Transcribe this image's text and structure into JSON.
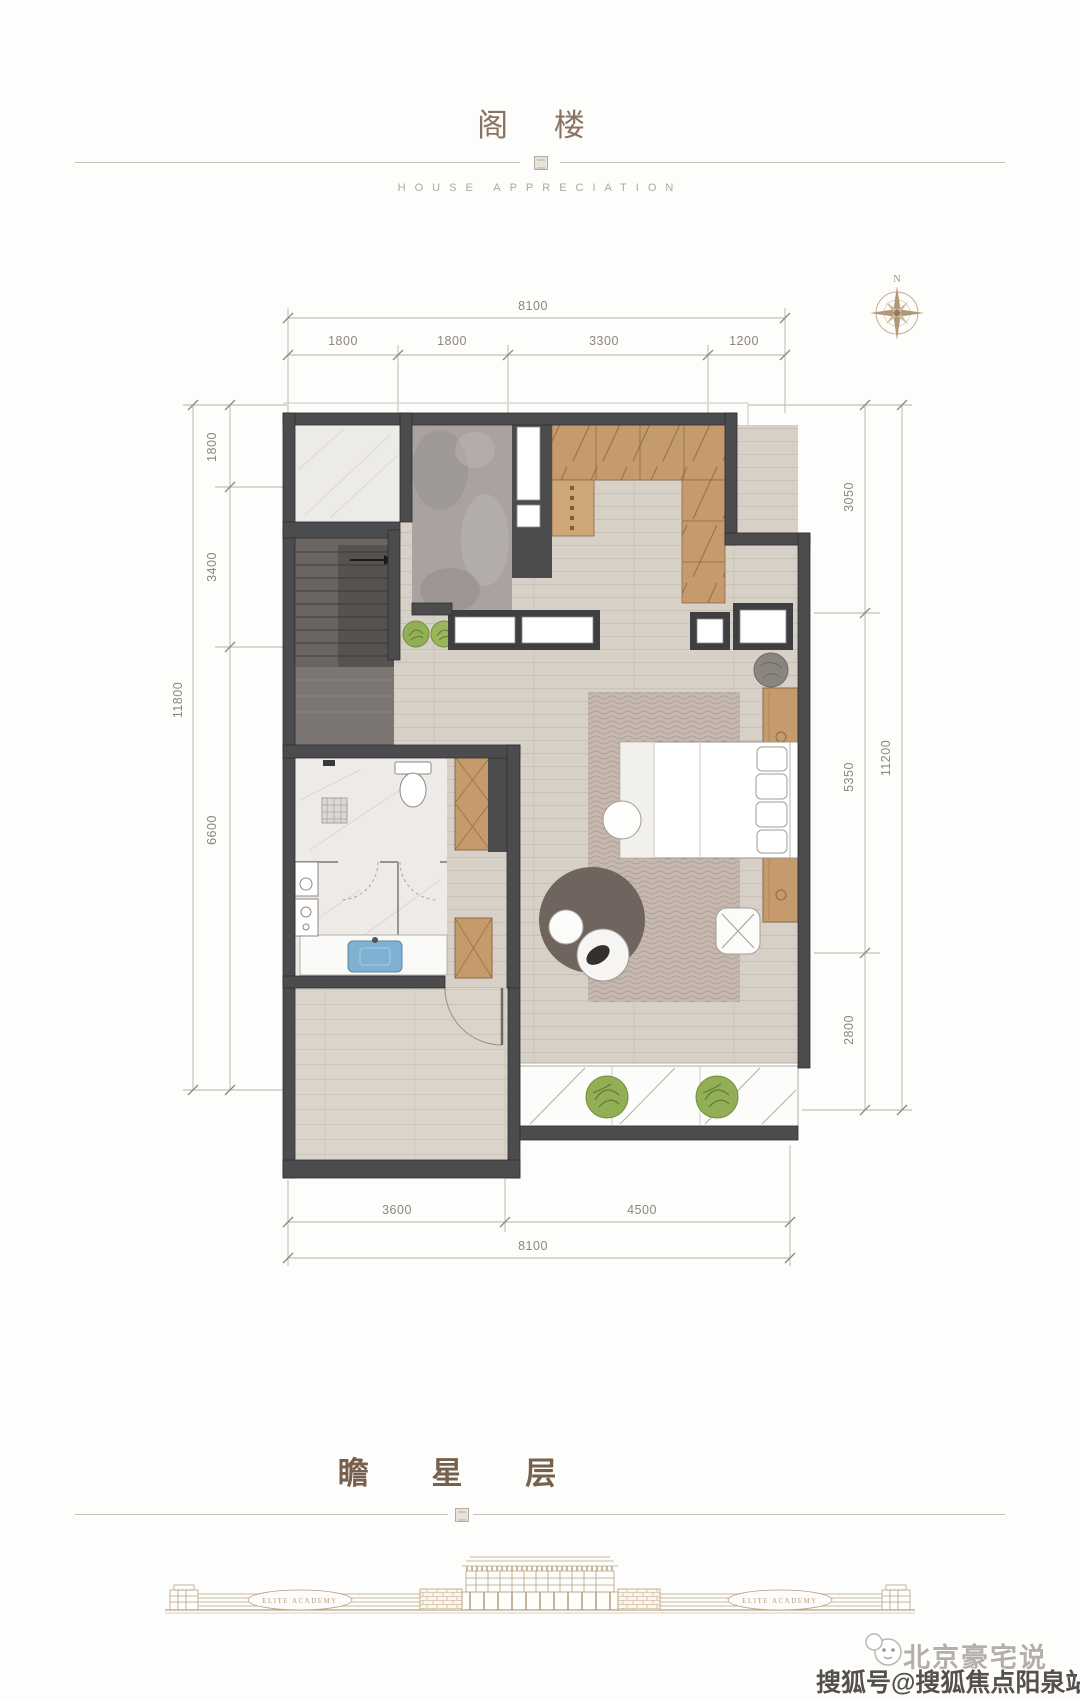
{
  "header": {
    "title": "阁 楼",
    "subtitle": "HOUSE APPRECIATION"
  },
  "footer": {
    "title": "瞻 星 层"
  },
  "compass": {
    "north": "N"
  },
  "dims": {
    "top": {
      "overall": "8100",
      "segments": [
        "1800",
        "1800",
        "3300",
        "1200"
      ]
    },
    "bottom": {
      "overall": "8100",
      "segments": [
        "3600",
        "4500"
      ]
    },
    "left": {
      "overall": "11800",
      "segments": [
        "1800",
        "3400",
        "6600"
      ]
    },
    "right": {
      "overall": "11200",
      "segments": [
        "3050",
        "5350",
        "2800"
      ]
    }
  },
  "elevation": {
    "left_label": "ELITE ACADEMY",
    "right_label": "ELITE ACADEMY"
  },
  "watermark": {
    "brand": "北京豪宅说",
    "account": "搜狐号@搜狐焦点阳泉站"
  },
  "colors": {
    "wall": "#4c4c4e",
    "wood_floor": "#d7d0c6",
    "marble_gray": "#a9a2a0",
    "marble_white": "#ecebe8",
    "wardrobe_tan": "#c59b6d",
    "rug": "#c6b7af",
    "plant_green": "#93af55",
    "dim_text": "#8f8579",
    "title_brown": "#8a7360",
    "sink_blue": "#7fb2d2"
  }
}
